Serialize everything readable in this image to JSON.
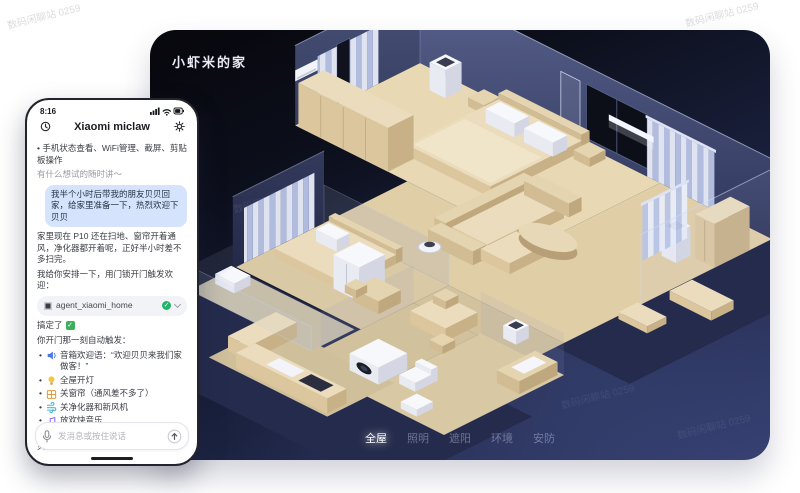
{
  "app": {
    "title": "小虾米的家",
    "nav": [
      {
        "label": "全屋",
        "active": true
      },
      {
        "label": "照明",
        "active": false
      },
      {
        "label": "遮阳",
        "active": false
      },
      {
        "label": "环境",
        "active": false
      },
      {
        "label": "安防",
        "active": false
      }
    ]
  },
  "watermark": {
    "text": "数码闲聊站 0259"
  },
  "phone": {
    "status": {
      "time": "8:16"
    },
    "header": {
      "title": "Xiaomi miclaw"
    },
    "intro_bullet": "手机状态查看、WiFi管理、截屏、剪贴板操作",
    "prompt": "有什么想试的随时讲～",
    "user_message": "我半个小时后带我的朋友贝贝回家，给家里准备一下，热烈欢迎下贝贝",
    "assistant": {
      "reply_1": "家里现在 P10 还在扫地、窗帘开着通风，净化器都开着呢，正好半小时差不多扫完。",
      "reply_2": "我给你安排一下，用门锁开门触发欢迎：",
      "agent_card": {
        "name": "agent_xiaomi_home"
      },
      "done": "搞定了",
      "trigger_intro": "你开门那一刻自动触发：",
      "actions": [
        {
          "icon": "speaker-icon",
          "text": "音箱欢迎语：“欢迎贝贝来我们家做客！”"
        },
        {
          "icon": "bulb-icon",
          "text": "全屋开灯"
        },
        {
          "icon": "curtain-icon",
          "text": "关窗帘（通风差不多了）"
        },
        {
          "icon": "fan-icon",
          "text": "关净化器和新风机"
        },
        {
          "icon": "music-icon",
          "text": "放欢快音乐"
        }
      ],
      "closing_1": "家里没人，音量不客气，排面拉满",
      "closing_2": "贝贝一进门就有仪式感！"
    },
    "input": {
      "placeholder": "发消息或按住说话"
    }
  },
  "colors": {
    "panel_navy": "#1b2240",
    "floor_beige": "#e0cea6",
    "accent_blue": "#d5e4fc",
    "success_green": "#23b567"
  }
}
